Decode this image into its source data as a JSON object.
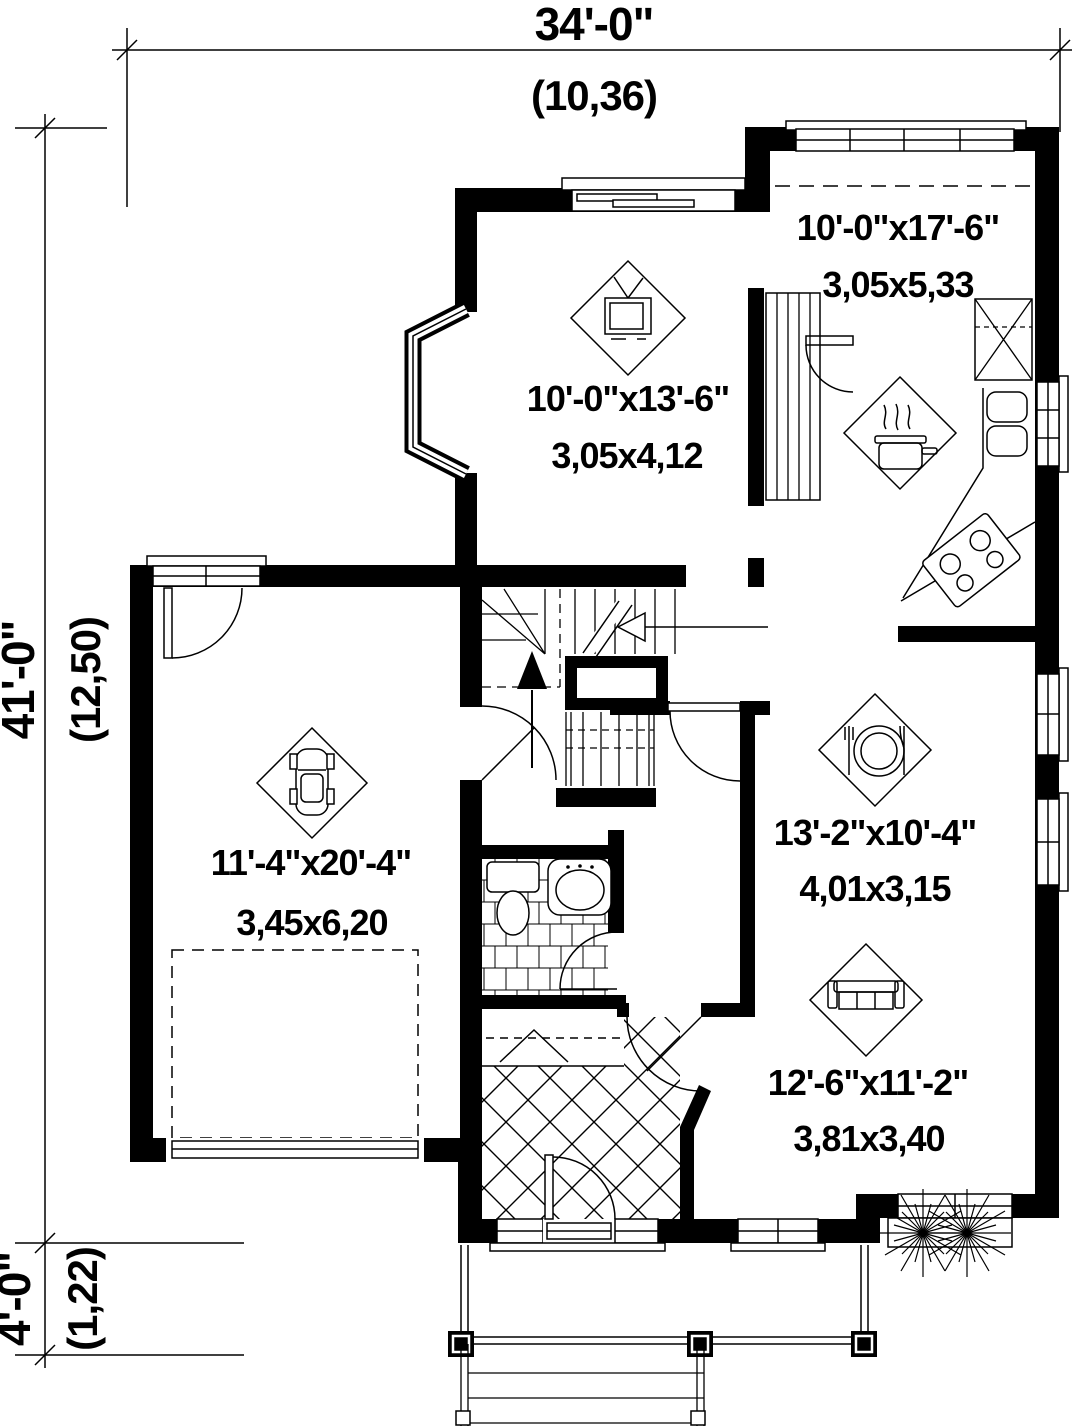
{
  "drawing_type": "house first-floor plan",
  "colors": {
    "ink": "#000000",
    "paper": "#ffffff"
  },
  "dims": {
    "width": {
      "imperial": "34'-0\"",
      "metric": "(10,36)"
    },
    "depth": {
      "imperial": "41'-0\"",
      "metric": "(12,50)"
    },
    "porch": {
      "imperial": "4'-0\"",
      "metric": "(1,22)"
    }
  },
  "rooms": {
    "kitchen": {
      "imperial": "10'-0\"x17'-6\"",
      "metric": "3,05x5,33",
      "icon": "cooking-pot"
    },
    "living": {
      "imperial": "10'-0\"x13'-6\"",
      "metric": "3,05x4,12",
      "icon": "tv"
    },
    "garage": {
      "imperial": "11'-4\"x20'-4\"",
      "metric": "3,45x6,20",
      "icon": "car"
    },
    "dining": {
      "imperial": "13'-2\"x10'-4\"",
      "metric": "4,01x3,15",
      "icon": "place-setting"
    },
    "family": {
      "imperial": "12'-6\"x11'-2\"",
      "metric": "3,81x3,40",
      "icon": "sofa"
    }
  }
}
